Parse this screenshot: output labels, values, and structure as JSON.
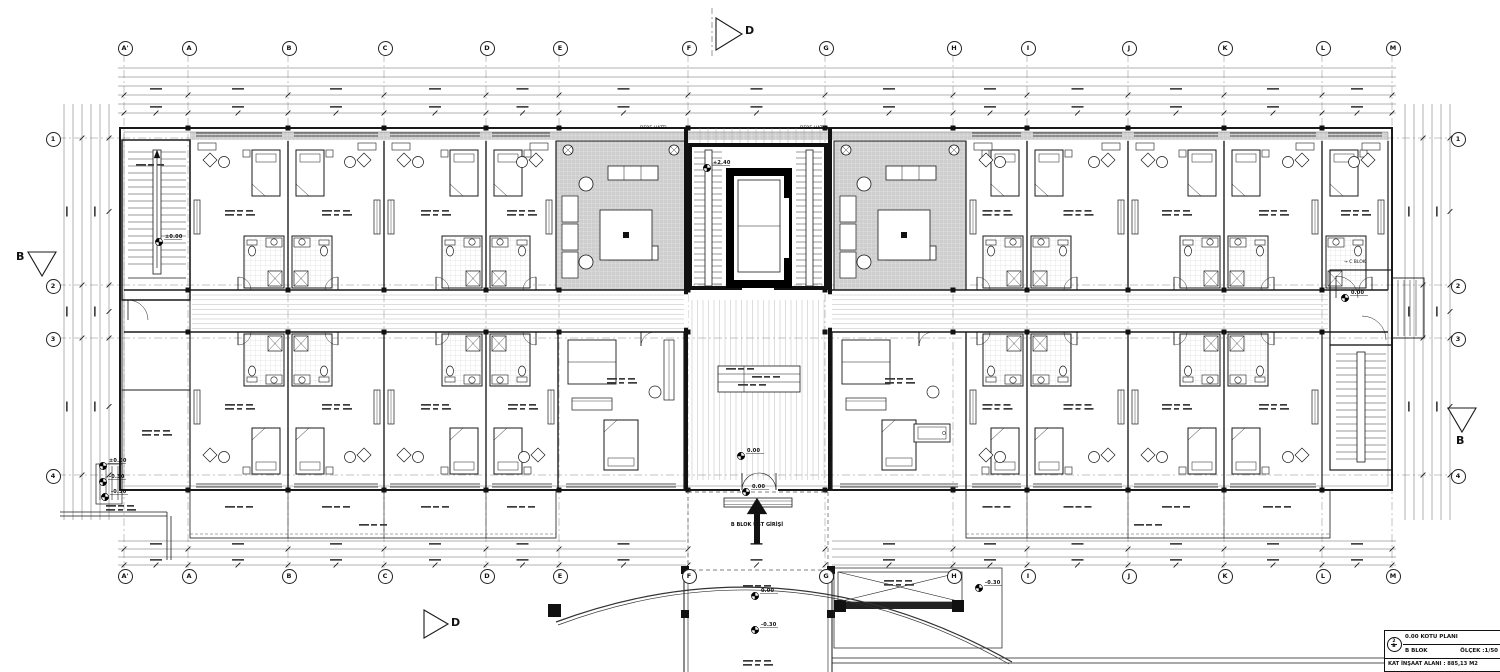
{
  "meta": {
    "line_color": "#1a1a1a",
    "fine_color": "#aaaaaa",
    "hatch_fill": "#d9d9d9",
    "paper": "#ffffff"
  },
  "title_block": {
    "ref_top": "2",
    "ref_bottom": "B",
    "plan_title": "0.00 KOTU PLANI",
    "block_name": "B BLOK",
    "scale_label": "ÖLÇEK :1/50",
    "area_label": "KAT İNŞAAT ALANI : 885,13 M2"
  },
  "grid": {
    "columns": [
      {
        "label": "A'",
        "x": 124
      },
      {
        "label": "A",
        "x": 188
      },
      {
        "label": "B",
        "x": 288
      },
      {
        "label": "C",
        "x": 384
      },
      {
        "label": "D",
        "x": 486
      },
      {
        "label": "E",
        "x": 559
      },
      {
        "label": "F",
        "x": 688
      },
      {
        "label": "G",
        "x": 825
      },
      {
        "label": "H",
        "x": 953
      },
      {
        "label": "I",
        "x": 1027
      },
      {
        "label": "J",
        "x": 1128
      },
      {
        "label": "K",
        "x": 1224
      },
      {
        "label": "L",
        "x": 1322
      },
      {
        "label": "M",
        "x": 1392
      }
    ],
    "rows": [
      {
        "label": "1",
        "y": 138
      },
      {
        "label": "2",
        "y": 285
      },
      {
        "label": "3",
        "y": 338
      },
      {
        "label": "4",
        "y": 475
      }
    ],
    "bubble_top_y": 47,
    "bubble_bottom_y": 575,
    "bubble_left_x": 52,
    "bubble_right_x": 1457
  },
  "section_markers": [
    {
      "label": "D",
      "pos": "top",
      "lx": 745,
      "ly": 24
    },
    {
      "label": "D",
      "pos": "bottom",
      "lx": 451,
      "ly": 616
    },
    {
      "label": "B",
      "pos": "left",
      "lx": 16,
      "ly": 250
    },
    {
      "label": "B",
      "pos": "right",
      "lx": 1456,
      "ly": 434
    }
  ],
  "level_markers": [
    {
      "value": "+2.40",
      "x": 714,
      "y": 164
    },
    {
      "value": "0.00",
      "x": 753,
      "y": 488
    },
    {
      "value": "0.00",
      "x": 748,
      "y": 452
    },
    {
      "value": "0.00",
      "x": 762,
      "y": 592
    },
    {
      "value": "-0.30",
      "x": 762,
      "y": 626
    },
    {
      "value": "-0.30",
      "x": 986,
      "y": 584
    },
    {
      "value": "0.00",
      "x": 1352,
      "y": 294
    },
    {
      "value": "±0.00",
      "x": 166,
      "y": 238
    },
    {
      "value": "±0.00",
      "x": 110,
      "y": 462
    },
    {
      "value": "-0.30",
      "x": 110,
      "y": 478
    },
    {
      "value": "-0.30",
      "x": 112,
      "y": 493
    }
  ],
  "annotations": [
    {
      "text": "B BLOK ÜST GİRİŞİ",
      "x": 757,
      "y": 522,
      "bold": true
    },
    {
      "text": "→ C BLOK",
      "x": 1344,
      "y": 260,
      "bold": false
    },
    {
      "text": "DERE HATTI",
      "x": 640,
      "y": 126,
      "bold": false
    },
    {
      "text": "DERE HATTI",
      "x": 800,
      "y": 126,
      "bold": false
    }
  ],
  "drawing": {
    "type": "architectural floor plan",
    "subject": "B Blok hotel block, ground (0.00) level",
    "visible_features": [
      "guest room wings",
      "central lobby with elevator and twin stairs",
      "two hatched lounge areas",
      "long central corridor",
      "fire stairs at both ends",
      "bottom-centre entrance with canopy, ramp and curved driveway"
    ]
  }
}
